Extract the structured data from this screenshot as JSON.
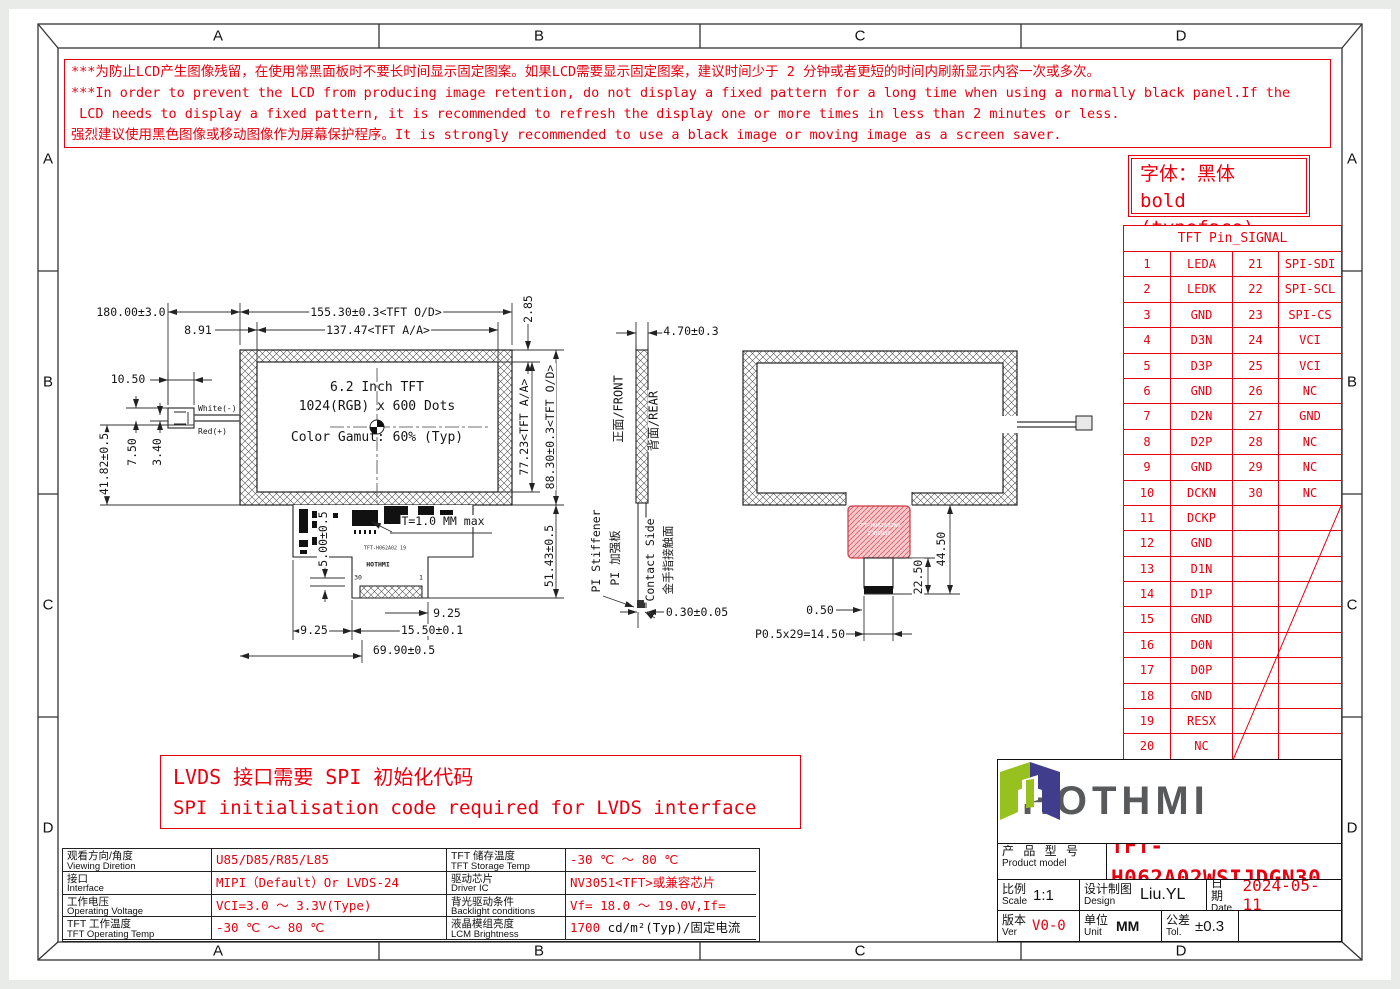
{
  "colors": {
    "red": "#e8000f",
    "line": "#1c1c1c",
    "logo_green": "#97c11f",
    "logo_blue": "#3f3d8c",
    "logo_gray": "#58595b"
  },
  "frame": {
    "top": [
      "A",
      "B",
      "C",
      "D"
    ],
    "bottom": [
      "A",
      "B",
      "C",
      "D"
    ],
    "left": [
      "A",
      "B",
      "C",
      "D"
    ],
    "right": [
      "A",
      "B",
      "C",
      "D"
    ]
  },
  "warning": {
    "line1": "***为防止LCD产生图像残留，在使用常黑面板时不要长时间显示固定图案。如果LCD需要显示固定图案，建议时间少于 2 分钟或者更短的时间内刷新显示内容一次或多次。",
    "line2": "***In order to prevent the LCD from producing image retention, do not display a fixed pattern for a long time when using a normally black panel.If the",
    "line3": " LCD needs to display a fixed pattern, it is recommended to refresh the display one or more times in less than 2 minutes or less.",
    "line4": "强烈建议使用黑色图像或移动图像作为屏幕保护程序。It is strongly recommended to use a black image or moving image as a screen saver."
  },
  "typeface_note": {
    "line1": "字体：黑体",
    "line2": "bold (typeface)"
  },
  "pin_table": {
    "title": "TFT Pin_SIGNAL",
    "rows": [
      {
        "p1": "1",
        "s1": "LEDA",
        "p2": "21",
        "s2": "SPI-SDI"
      },
      {
        "p1": "2",
        "s1": "LEDK",
        "p2": "22",
        "s2": "SPI-SCL"
      },
      {
        "p1": "3",
        "s1": "GND",
        "p2": "23",
        "s2": "SPI-CS"
      },
      {
        "p1": "4",
        "s1": "D3N",
        "p2": "24",
        "s2": "VCI"
      },
      {
        "p1": "5",
        "s1": "D3P",
        "p2": "25",
        "s2": "VCI"
      },
      {
        "p1": "6",
        "s1": "GND",
        "p2": "26",
        "s2": "NC"
      },
      {
        "p1": "7",
        "s1": "D2N",
        "p2": "27",
        "s2": "GND"
      },
      {
        "p1": "8",
        "s1": "D2P",
        "p2": "28",
        "s2": "NC"
      },
      {
        "p1": "9",
        "s1": "GND",
        "p2": "29",
        "s2": "NC"
      },
      {
        "p1": "10",
        "s1": "DCKN",
        "p2": "30",
        "s2": "NC"
      },
      {
        "p1": "11",
        "s1": "DCKP",
        "p2": "",
        "s2": ""
      },
      {
        "p1": "12",
        "s1": "GND",
        "p2": "",
        "s2": ""
      },
      {
        "p1": "13",
        "s1": "D1N",
        "p2": "",
        "s2": ""
      },
      {
        "p1": "14",
        "s1": "D1P",
        "p2": "",
        "s2": ""
      },
      {
        "p1": "15",
        "s1": "GND",
        "p2": "",
        "s2": ""
      },
      {
        "p1": "16",
        "s1": "D0N",
        "p2": "",
        "s2": ""
      },
      {
        "p1": "17",
        "s1": "D0P",
        "p2": "",
        "s2": ""
      },
      {
        "p1": "18",
        "s1": "GND",
        "p2": "",
        "s2": ""
      },
      {
        "p1": "19",
        "s1": "RESX",
        "p2": "",
        "s2": ""
      },
      {
        "p1": "20",
        "s1": "NC",
        "p2": "",
        "s2": ""
      }
    ]
  },
  "front_view": {
    "display_lines": {
      "l1": "6.2 Inch TFT",
      "l2": "1024(RGB) x 600 Dots",
      "l3": "Color Gamut: 60% (Typ)"
    },
    "dims": {
      "wire_length": "180.00±3.0",
      "outline_width": "155.30±0.3<TFT O/D>",
      "aa_offset": "8.91",
      "aa_width": "137.47<TFT A/A>",
      "top_margin": "2.85",
      "connector_width": "10.50",
      "left_height": "41.82±0.5",
      "wire_gap_a": "7.50",
      "wire_gap_b": "3.40",
      "aa_height": "77.23<TFT A/A>",
      "outline_height": "88.30±0.3<TFT O/D>",
      "fpc_step": "5.00±0.5",
      "thickness": "T=1.0 MM max",
      "fpc_length": "51.43±0.5",
      "tail_offset_right": "9.25",
      "tail_offset_left": "9.25",
      "tail_width": "15.50±0.1",
      "fpc_width": "69.90±0.5"
    },
    "wires": {
      "white": "White(-)",
      "red": "Red(+)"
    },
    "fpc": {
      "marking": "TFT-H062A02 19",
      "logo": "HOTHMI",
      "pin_left": "30",
      "pin_right": "1"
    }
  },
  "side_view": {
    "dims": {
      "thickness_top": "4.70±0.3",
      "thickness_bottom": "0.30±0.05"
    },
    "labels": {
      "front": "正面/FRONT",
      "rear": "背面/REAR",
      "stiffener_en": "PI Stiffener",
      "stiffener_cn": "PI 加强板",
      "contact_en": "Contact Side",
      "contact_cn": "金手指接触面"
    }
  },
  "rear_view": {
    "dims": {
      "total": "44.50",
      "tail": "22.50",
      "bar": "0.50",
      "pitch": "P0.5x29=14.50"
    },
    "sticker": {
      "line1": "TFT-H062A02WS",
      "line2": "IJDGN30"
    }
  },
  "lvds_note": {
    "line1": "LVDS 接口需要 SPI 初始化代码",
    "line2": "SPI initialisation code required for LVDS interface"
  },
  "spec_table": {
    "rows": [
      {
        "label1_cn": "观看方向/角度",
        "label1_en": "Viewing Diretion",
        "value1": "U85/D85/R85/L85",
        "label2_cn": "TFT 储存温度",
        "label2_en": "TFT Storage Temp",
        "value2": "-30 ℃ ～ 80 ℃"
      },
      {
        "label1_cn": "接口",
        "label1_en": "Interface",
        "value1": "MIPI（Default）Or LVDS-24 Bit+SPI",
        "label2_cn": "驱动芯片",
        "label2_en": "Driver IC",
        "value2": "NV3051<TFT>或兼容芯片"
      },
      {
        "label1_cn": "工作电压",
        "label1_en": "Operating Voltage",
        "value1": "VCI=3.0 ～ 3.3V(Type)",
        "label2_cn": "背光驱动条件",
        "label2_en": "Backlight conditions",
        "value2": "Vf= 18.0 ～ 19.0V,If= 160 mA"
      },
      {
        "label1_cn": "TFT 工作温度",
        "label1_en": "TFT Operating Temp",
        "value1": "-30 ℃ ～ 80 ℃",
        "label2_cn": "液晶模组亮度",
        "label2_en": "LCM Brightness",
        "value2_red": "1700",
        "value2_black": " cd/m²(Typ)/固定电流测试"
      }
    ]
  },
  "title_block": {
    "logo_text": "HOTHMI",
    "product_label_cn": "产 品 型 号",
    "product_label_en": "Product model",
    "product_model": "TFT-H062A02WSIJDGN30",
    "scale_cn": "比例",
    "scale_en": "Scale",
    "scale_val": "1:1",
    "design_cn": "设计制图",
    "design_en": "Design",
    "design_val": "Liu.YL",
    "date_cn": "日期",
    "date_en": "Date",
    "date_val": "2024-05-11",
    "ver_cn": "版本",
    "ver_en": "Ver",
    "ver_val": "V0-0",
    "unit_cn": "单位",
    "unit_en": "Unit",
    "unit_val": "MM",
    "tol_cn": "公差",
    "tol_en": "Tol.",
    "tol_val": "±0.3"
  }
}
